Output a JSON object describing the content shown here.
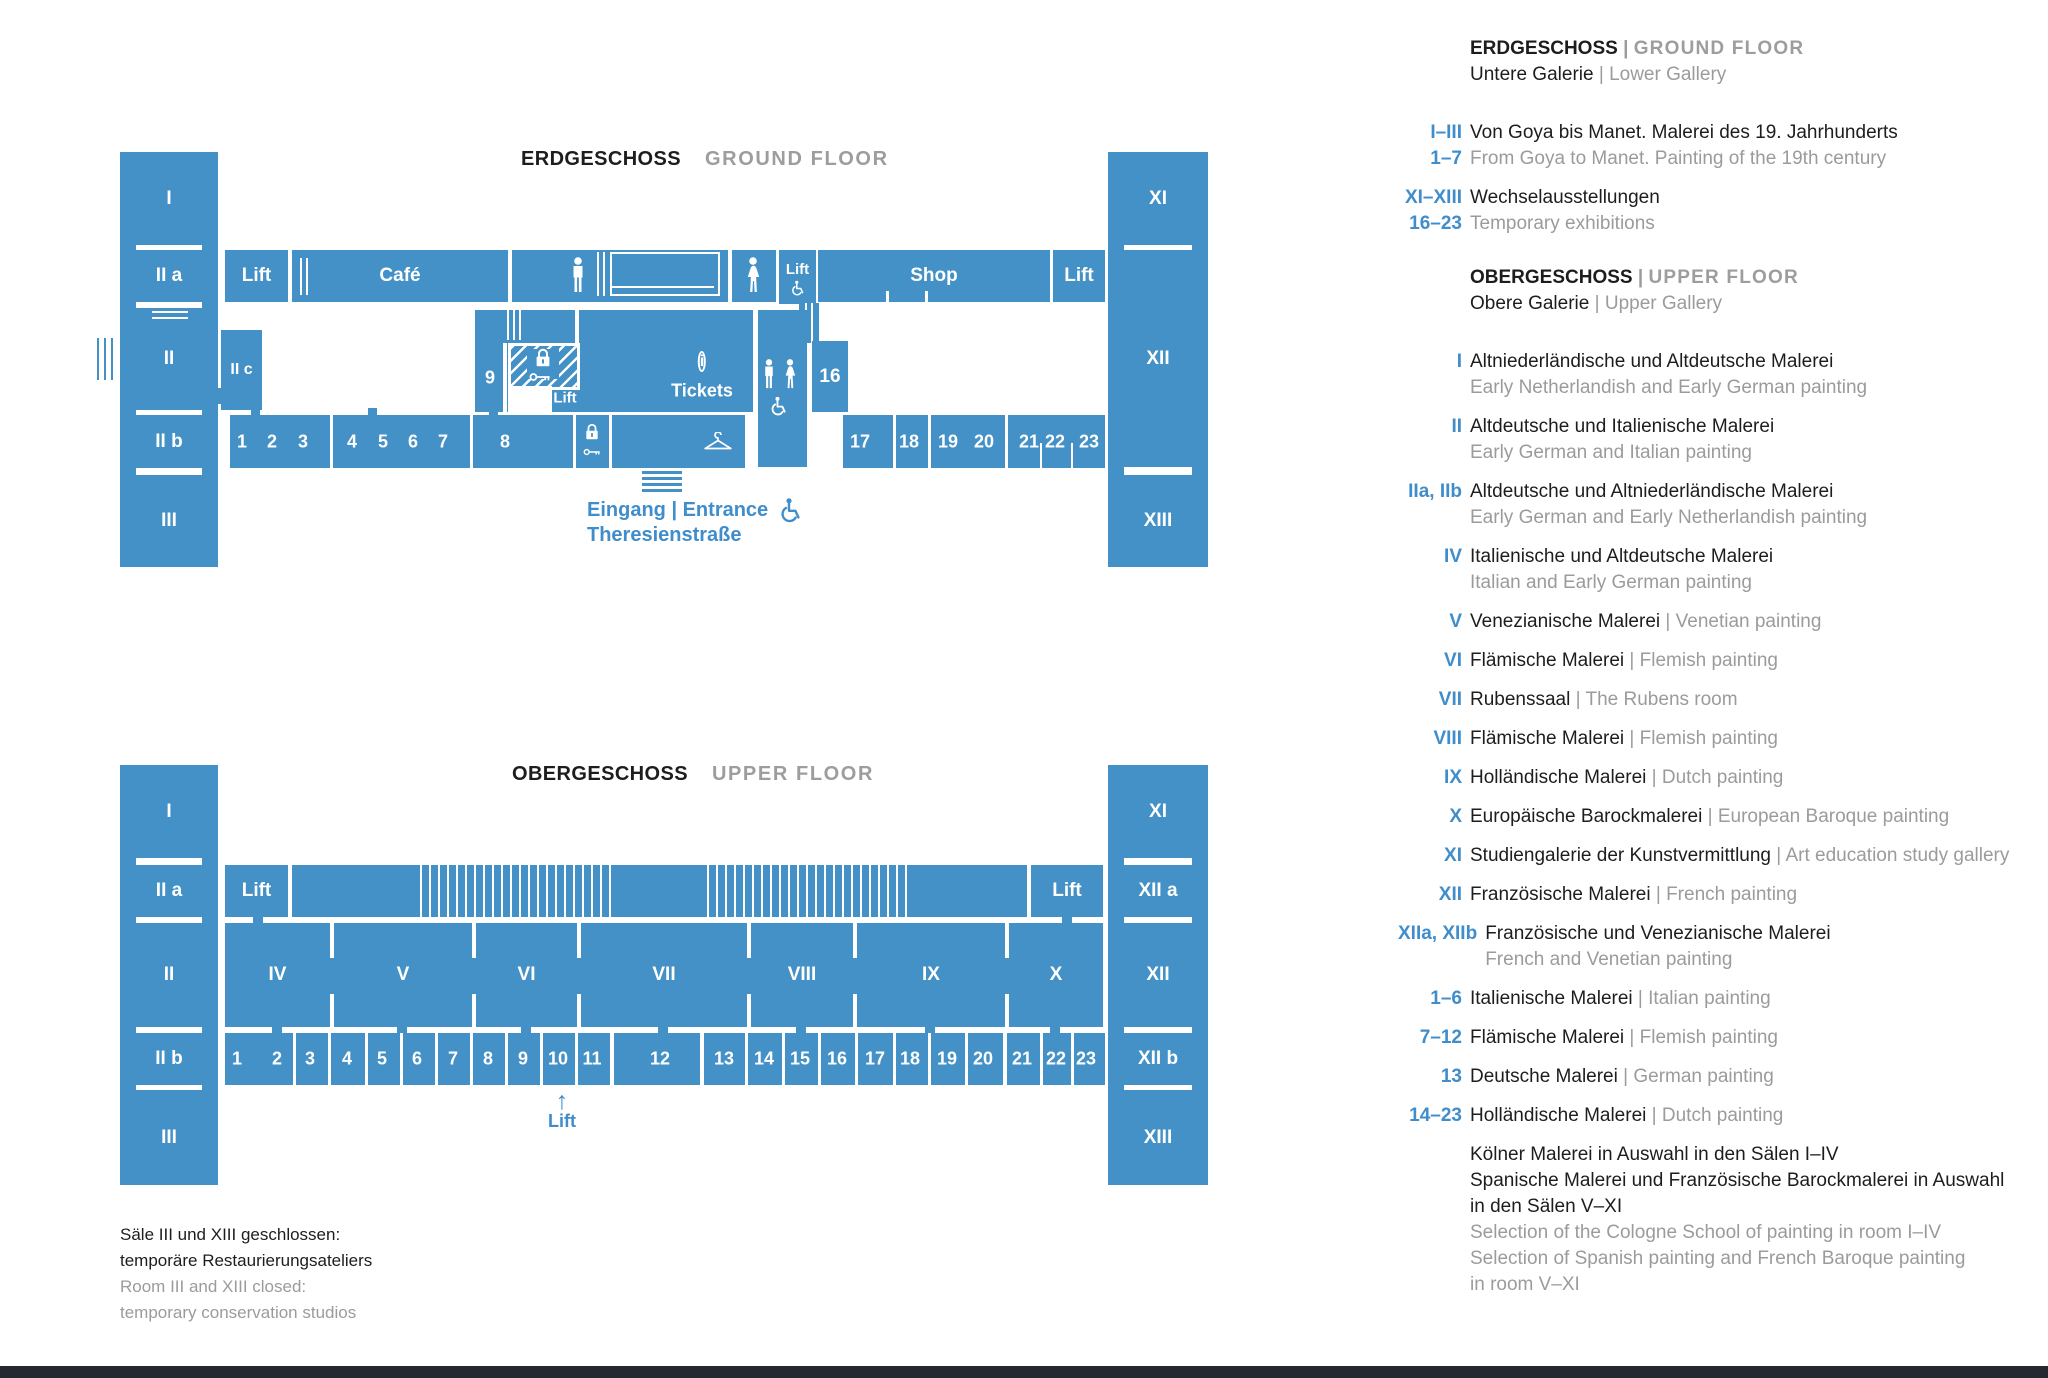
{
  "colors": {
    "plan_blue": "#4391c6",
    "accent_blue": "#3f8dcb",
    "text_black": "#1d1d1b",
    "text_gray": "#9b9b9a",
    "footer_dark": "#25282e"
  },
  "gf": {
    "title_de": "ERDGESCHOSS",
    "title_en": "GROUND FLOOR",
    "rooms": {
      "I": "I",
      "IIa": "II a",
      "II": "II",
      "IIc": "II c",
      "IIb": "II b",
      "III": "III",
      "XI": "XI",
      "XII": "XII",
      "XIII": "XIII",
      "lift_a": "Lift",
      "cafe": "Café",
      "lift_c": "Lift",
      "shop": "Shop",
      "lift_b": "Lift",
      "r9": "9",
      "lift_d": "Lift",
      "tickets": "Tickets",
      "r16": "16"
    },
    "numbers_left": [
      "1",
      "2",
      "3",
      "4",
      "5",
      "6",
      "7",
      "8"
    ],
    "numbers_right": [
      "17",
      "18",
      "19",
      "20",
      "21",
      "22",
      "23"
    ],
    "entrance_line1": "Eingang | Entrance",
    "entrance_line2": "Theresienstraße"
  },
  "of": {
    "title_de": "OBERGESCHOSS",
    "title_en": "UPPER FLOOR",
    "rooms": {
      "I": "I",
      "IIa": "II a",
      "II": "II",
      "IIb": "II b",
      "III": "III",
      "XI": "XI",
      "XIIa": "XII a",
      "XII": "XII",
      "XIIb": "XII b",
      "XIII": "XIII",
      "lift_a": "Lift",
      "lift_b": "Lift",
      "IV": "IV",
      "V": "V",
      "VI": "VI",
      "VII": "VII",
      "VIII": "VIII",
      "IX": "IX",
      "X": "X"
    },
    "numbers": [
      "1",
      "2",
      "3",
      "4",
      "5",
      "6",
      "7",
      "8",
      "9",
      "10",
      "11",
      "12",
      "13",
      "14",
      "15",
      "16",
      "17",
      "18",
      "19",
      "20",
      "21",
      "22",
      "23"
    ],
    "lift_arrow": "↑",
    "lift_label": "Lift"
  },
  "note": {
    "de1": "Säle III und XIII geschlossen:",
    "de2": "temporäre Restaurierungsateliers",
    "en1": "Room III and XIII closed:",
    "en2": "temporary conservation studios"
  },
  "legend": {
    "gf": {
      "title_de": "ERDGESCHOSS",
      "title_en": "GROUND FLOOR",
      "subtitle_de": "Untere Galerie",
      "subtitle_en": "Lower Gallery",
      "items": [
        {
          "code_de": "I–III",
          "code_en": "1–7",
          "de": "Von Goya bis Manet. Malerei des 19. Jahrhunderts",
          "en": "From Goya to Manet. Painting of the 19th century"
        },
        {
          "code_de": "XI–XIII",
          "code_en": "16–23",
          "de": "Wechselausstellungen",
          "en": "Temporary exhibitions"
        }
      ]
    },
    "of": {
      "title_de": "OBERGESCHOSS",
      "title_en": "UPPER FLOOR",
      "subtitle_de": "Obere Galerie",
      "subtitle_en": "Upper Gallery",
      "items": [
        {
          "code": "I",
          "de": "Altniederländische und Altdeutsche Malerei",
          "en": "Early Netherlandish and Early German painting"
        },
        {
          "code": "II",
          "de": "Altdeutsche und Italienische Malerei",
          "en": "Early German and Italian painting"
        },
        {
          "code": "IIa, IIb",
          "de": "Altdeutsche und Altniederländische Malerei",
          "en": "Early German and Early Netherlandish painting"
        },
        {
          "code": "IV",
          "de": "Italienische und Altdeutsche Malerei",
          "en": "Italian and Early German painting"
        },
        {
          "code": "V",
          "de": "Venezianische Malerei",
          "en": "Venetian painting"
        },
        {
          "code": "VI",
          "de": "Flämische Malerei",
          "en": "Flemish painting"
        },
        {
          "code": "VII",
          "de": "Rubenssaal",
          "en": "The Rubens room"
        },
        {
          "code": "VIII",
          "de": "Flämische Malerei",
          "en": "Flemish painting"
        },
        {
          "code": "IX",
          "de": "Holländische Malerei",
          "en": "Dutch painting"
        },
        {
          "code": "X",
          "de": "Europäische Barockmalerei",
          "en": "European Baroque painting"
        },
        {
          "code": "XI",
          "de": "Studiengalerie der Kunstvermittlung",
          "en": "Art education study gallery"
        },
        {
          "code": "XII",
          "de": "Französische Malerei",
          "en": "French painting"
        },
        {
          "code": "XIIa, XIIb",
          "de": "Französische und Venezianische Malerei",
          "en": "French and Venetian painting"
        },
        {
          "code": "1–6",
          "de": "Italienische Malerei",
          "en": "Italian painting"
        },
        {
          "code": "7–12",
          "de": "Flämische Malerei",
          "en": "Flemish painting"
        },
        {
          "code": "13",
          "de": "Deutsche Malerei",
          "en": "German painting"
        },
        {
          "code": "14–23",
          "de": "Holländische Malerei",
          "en": "Dutch painting"
        }
      ],
      "footnote_de": [
        "Kölner Malerei in Auswahl in den Sälen I–IV",
        "Spanische Malerei und Französische Barockmalerei in Auswahl",
        "in den Sälen V–XI"
      ],
      "footnote_en": [
        "Selection of the Cologne School of painting in room I–IV",
        "Selection of Spanish painting and French Baroque painting",
        "in room V–XI"
      ]
    }
  }
}
